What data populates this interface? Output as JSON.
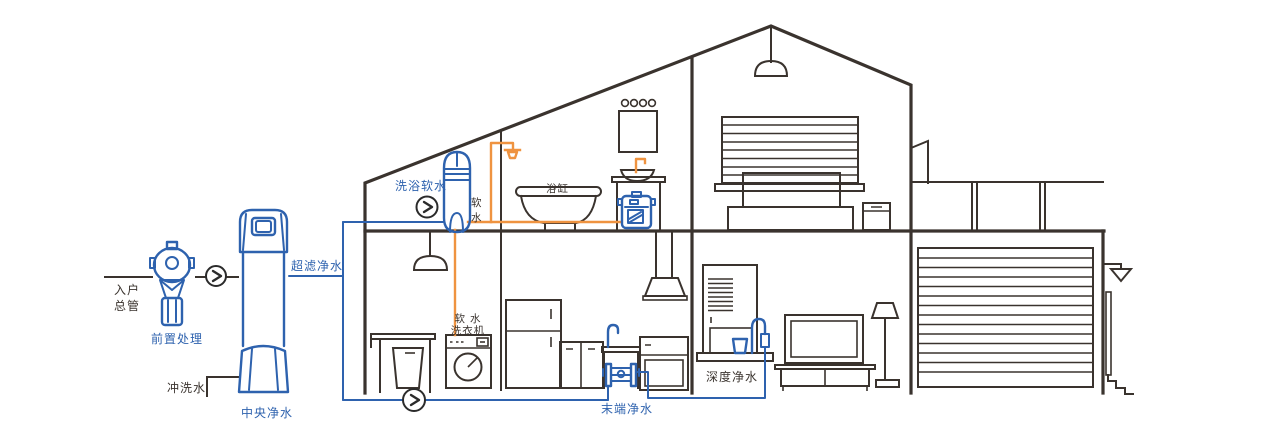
{
  "colors": {
    "outline": "#3a332e",
    "pipe_blue": "#2e62ae",
    "pipe_orange": "#ef9340",
    "background": "#ffffff"
  },
  "labels": {
    "entry_main_line1": "入户",
    "entry_main_line2": "总管",
    "pre_treatment": "前置处理",
    "flush_water": "冲洗水",
    "central_purifier": "中央净水",
    "uf_water": "超滤净水",
    "bath_softener": "洗浴软水",
    "soft_water_char1": "软",
    "soft_water_char2": "水",
    "bathtub": "浴缸",
    "washer_line1": "软 水",
    "washer_line2": "洗衣机",
    "terminal_purifier": "末端净水",
    "deep_purifier": "深度净水"
  }
}
